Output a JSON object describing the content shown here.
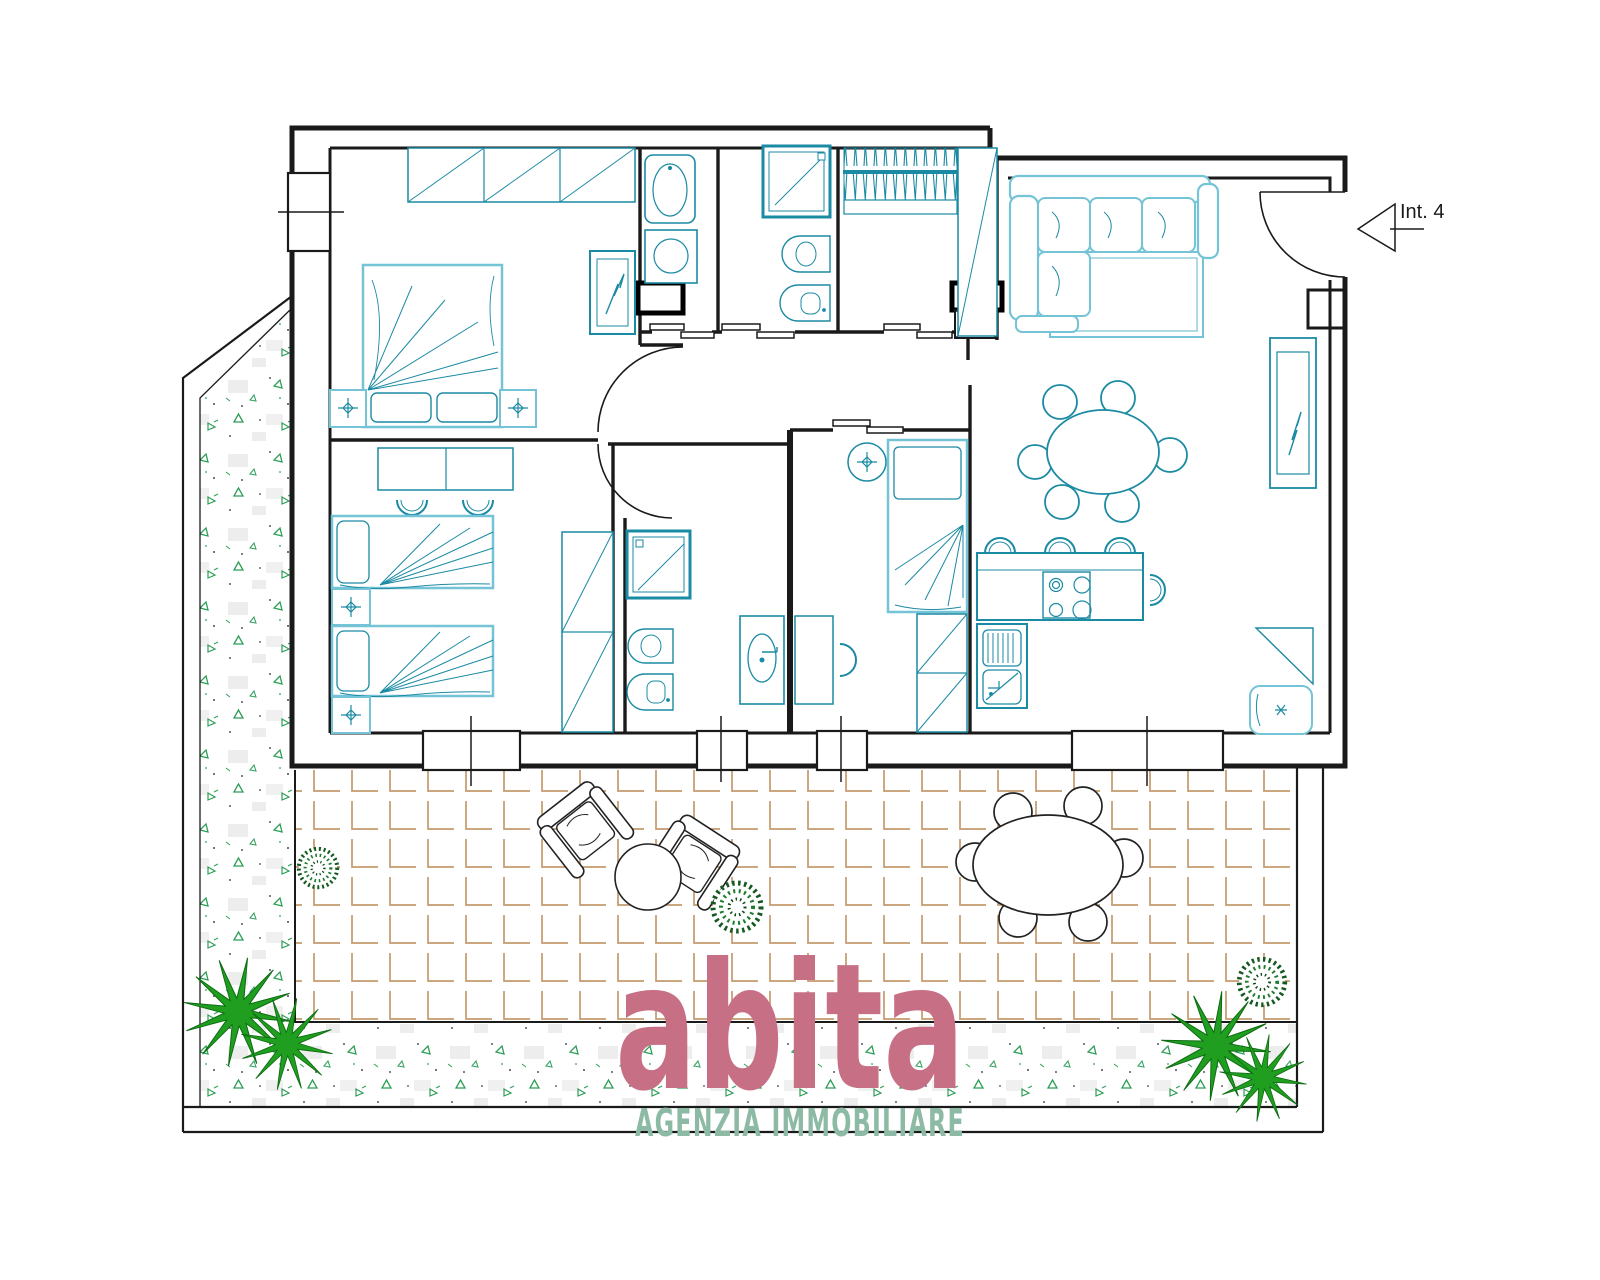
{
  "labels": {
    "unit": "Int. 4",
    "logo": "abita",
    "logo_sub": "AGENZIA IMMOBILIARE"
  },
  "colors": {
    "walls": "#1a1a1a",
    "furniture_teal": "#1b8aa3",
    "furniture_teal_light": "#74c3d6",
    "tile_grout": "#c49a6c",
    "garden_green": "#2e9e57",
    "palm_green": "#1f9e1f",
    "bush_green": "#2d9440",
    "logo_pink": "#c76f85",
    "logo_green": "#8cbaa4",
    "background": "#ffffff"
  },
  "plan": {
    "unit_label": "Int. 4",
    "rooms": [
      "master-bedroom",
      "twin-bedroom",
      "laundry-room",
      "bathroom-1",
      "walk-in-closet",
      "bathroom-2",
      "single-bedroom",
      "kitchen",
      "living-dining-room",
      "hallway",
      "terrace",
      "garden"
    ],
    "furniture_icons": [
      "wardrobe-icon",
      "double-bed-icon",
      "nightstand-icon",
      "mirror-icon",
      "desk-icon",
      "chair-icon",
      "single-bed-icon",
      "shower-icon",
      "bidet-icon",
      "wc-icon",
      "washbasin-icon",
      "washing-machine-icon",
      "clothes-rack-icon",
      "vanity-sink-icon",
      "kitchen-counter-icon",
      "hob-icon",
      "kitchen-sink-icon",
      "bar-stool-icon",
      "dining-table-icon",
      "corner-sofa-icon",
      "rug-icon",
      "tv-cabinet-icon",
      "armchair-icon",
      "outdoor-armchair-icon",
      "coffee-table-icon",
      "outdoor-dining-set-icon",
      "palm-tree-icon",
      "bush-icon",
      "entrance-door-icon",
      "window-icon",
      "sliding-door-icon"
    ]
  }
}
